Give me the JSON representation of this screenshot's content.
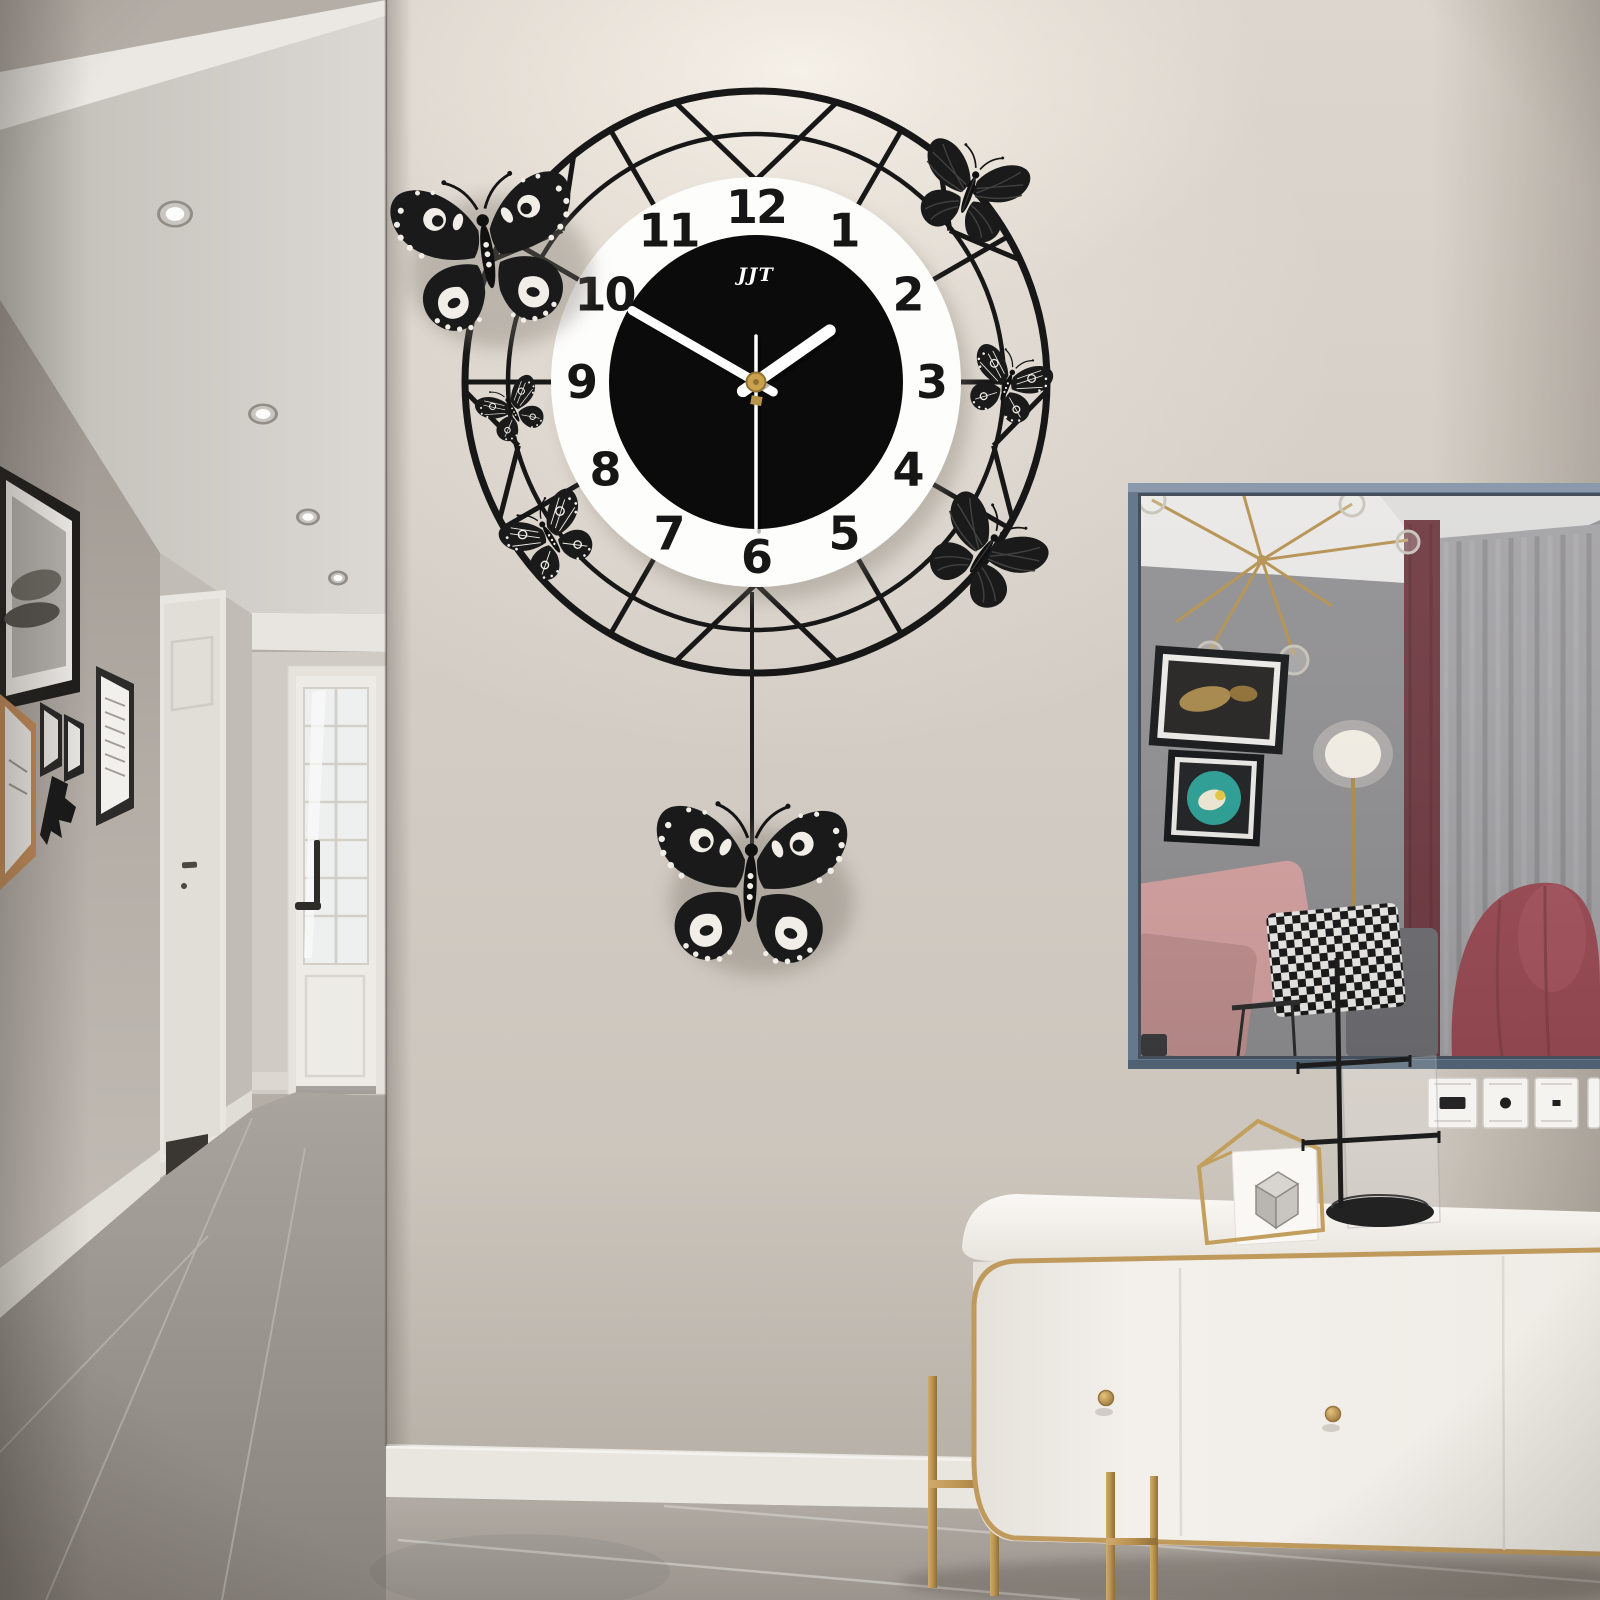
{
  "scene": {
    "description": "Black butterfly pendulum wall clock on a greige wall between a hallway and a mirrored console area",
    "wall_color": "#d2ccc4",
    "glow_color": "#f6f1e9",
    "hallway_wall_color": "#b4aea7",
    "floor_color": "#a49e98",
    "baseboard_color": "#e9e6e0"
  },
  "clock": {
    "brand": "JJT",
    "time_reading": "1:50:30",
    "center": {
      "x": 756,
      "y": 382
    },
    "radii": {
      "outer_ring": 291,
      "inner_ring": 248,
      "dial": 205,
      "black_face": 147,
      "numeral_radius": 175
    },
    "ring_color": "#171717",
    "dial_color": "#fdfdfc",
    "face_color": "#0b0b0b",
    "numeral_color": "#161616",
    "numerals": [
      "12",
      "1",
      "2",
      "3",
      "4",
      "5",
      "6",
      "7",
      "8",
      "9",
      "10",
      "11"
    ],
    "ring": {
      "spokes": [
        30,
        60,
        90,
        120,
        150,
        210,
        240,
        270,
        300,
        330
      ],
      "vees_dial": [
        0,
        180
      ],
      "vees_inner": [
        52,
        105,
        255,
        308
      ]
    },
    "hands": {
      "hour_angle_deg": 55,
      "minute_angle_deg": 300,
      "second_angle_deg": 180,
      "hour_length": 90,
      "minute_length": 143,
      "second_length": 146,
      "hand_color": "#ffffff",
      "cap_color": "#c9a24b"
    },
    "pendulum": {
      "wire_x": 752,
      "wire_top": 592,
      "wire_bottom": 858
    }
  },
  "butterflies": [
    {
      "name": "butterfly-large-upper-left",
      "style": "cutout",
      "x": 488,
      "y": 258,
      "scale": 0.95,
      "rot": -8
    },
    {
      "name": "butterfly-top-right",
      "style": "solid",
      "x": 968,
      "y": 196,
      "scale": 0.56,
      "rot": 20
    },
    {
      "name": "butterfly-right-lace",
      "style": "lace",
      "x": 1006,
      "y": 388,
      "scale": 0.42,
      "rot": 22
    },
    {
      "name": "butterfly-lower-right",
      "style": "solid",
      "x": 981,
      "y": 557,
      "scale": 0.58,
      "rot": 35
    },
    {
      "name": "butterfly-left-lace",
      "style": "lace",
      "x": 514,
      "y": 412,
      "scale": 0.34,
      "rot": -28
    },
    {
      "name": "butterfly-lower-left-lace",
      "style": "lace",
      "x": 552,
      "y": 540,
      "scale": 0.46,
      "rot": -32
    },
    {
      "name": "butterfly-pendulum",
      "style": "cutout",
      "x": 750,
      "y": 890,
      "scale": 1.0,
      "rot": 2
    }
  ],
  "hallway": {
    "ceiling_lights": [
      {
        "x": 175,
        "y": 214,
        "rx": 15,
        "ry": 11
      },
      {
        "x": 263,
        "y": 414,
        "rx": 12,
        "ry": 8
      },
      {
        "x": 308,
        "y": 517,
        "rx": 9,
        "ry": 6
      },
      {
        "x": 338,
        "y": 578,
        "rx": 7,
        "ry": 5
      }
    ],
    "frame_count": 6,
    "door_count": 2
  },
  "mirror": {
    "frame_color": "#66788c",
    "contents": [
      "sputnik-chandelier",
      "art-frame-koi",
      "art-frame-teal-plate",
      "floor-lamp",
      "pink-pillows",
      "houndstooth-pillow",
      "gray-sofa",
      "maroon-curtain",
      "sheer-curtain",
      "pink-armchair"
    ]
  },
  "switches": {
    "y": 1078,
    "height": 50,
    "plates": [
      {
        "x": 1428,
        "width": 49,
        "mark": "socket"
      },
      {
        "x": 1483,
        "width": 45,
        "mark": "dot"
      },
      {
        "x": 1535,
        "width": 43,
        "mark": "dot-small"
      },
      {
        "x": 1588,
        "width": 12,
        "mark": "edge"
      }
    ]
  },
  "bench": {
    "body_color": "#f2efeb",
    "trim_color": "#c09a5c",
    "knobs": [
      {
        "x": 1106,
        "y": 1398
      },
      {
        "x": 1333,
        "y": 1414
      }
    ]
  },
  "ornament": {
    "type": "gold-geometric-frame-with-marble-cube"
  },
  "stand": {
    "type": "black-jewelry-stand-with-oval-tray"
  }
}
